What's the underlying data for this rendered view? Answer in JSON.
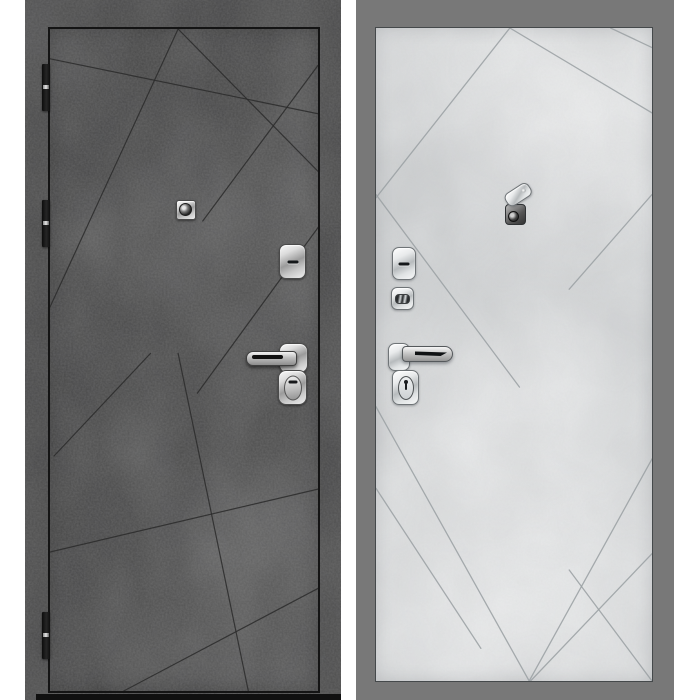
{
  "product": {
    "type": "steel entrance door product photo",
    "views": [
      "exterior side (dark concrete)",
      "interior side (light concrete)"
    ]
  },
  "background": "#ffffff",
  "panels": {
    "left": {
      "label": "exterior-panel-dark-concrete",
      "colors": {
        "frame": "#4a4a4a",
        "leaf": "#505050",
        "groove": "#2b2b2b",
        "outline": "#141414",
        "threshold": "#101010",
        "hinge": "#262626"
      },
      "grooves": [
        [
          0,
          4.5,
          100,
          12.8
        ],
        [
          47.8,
          0,
          0,
          42
        ],
        [
          47.8,
          0,
          100,
          21.5
        ],
        [
          100,
          5.5,
          57,
          29
        ],
        [
          100,
          30,
          55,
          55
        ],
        [
          37.5,
          49,
          1.5,
          64.5
        ],
        [
          0,
          79,
          100,
          69.5
        ],
        [
          47.8,
          49,
          74,
          100
        ],
        [
          100,
          84.5,
          27.5,
          100
        ]
      ],
      "hinges": [
        64,
        200,
        612
      ],
      "hardware": [
        "peephole",
        "upper-lock-cover",
        "lever-handle",
        "key-cylinder-cover"
      ]
    },
    "right": {
      "label": "interior-panel-light-concrete",
      "colors": {
        "frame": "#787878",
        "leaf": "#d8dadb",
        "groove": "#9aa0a3",
        "outline": "#45494b"
      },
      "grooves": [
        [
          48.5,
          0,
          0,
          26
        ],
        [
          48.5,
          0,
          100,
          13
        ],
        [
          85,
          0,
          100,
          3
        ],
        [
          100,
          25.5,
          70,
          40
        ],
        [
          0,
          58,
          55.5,
          100
        ],
        [
          100,
          66,
          55.5,
          100
        ],
        [
          0,
          70.5,
          38,
          95
        ],
        [
          0,
          25.5,
          52,
          55
        ],
        [
          100,
          80.5,
          56,
          100
        ],
        [
          70,
          83,
          100,
          100
        ]
      ],
      "hardware": [
        "peephole-swivel-cover",
        "upper-lock-cover",
        "thumbturn",
        "lever-handle",
        "key-cylinder-cover"
      ]
    }
  }
}
